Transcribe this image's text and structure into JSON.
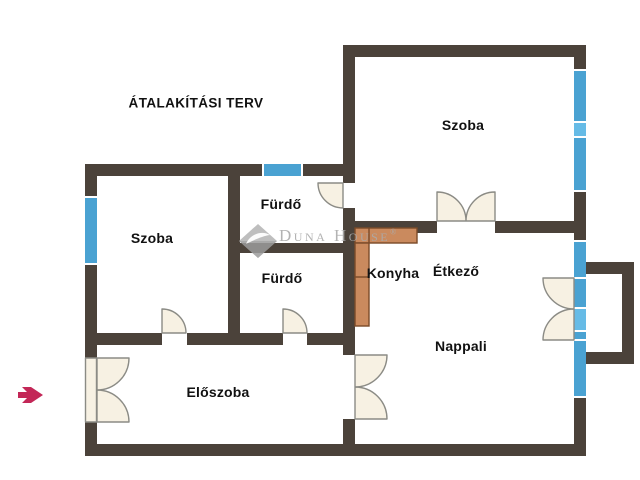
{
  "title": "ÁTALAKÍTÁSI TERV",
  "watermark": {
    "brand": "Duna House",
    "registered": "®"
  },
  "rooms": {
    "szoba_top": "Szoba",
    "szoba_left": "Szoba",
    "furdo_top": "Fürdő",
    "furdo_bottom": "Fürdő",
    "konyha": "Konyha",
    "etkezo": "Étkező",
    "nappali": "Nappali",
    "eloszoba": "Előszoba"
  },
  "icons": {
    "entrance_arrow": "entrance-arrow-icon",
    "brand_diamond": "brand-diamond-icon"
  },
  "colors": {
    "wall": "#4b423a",
    "window": "#4aa2d2",
    "window_light": "#66bbe6",
    "counter": "#ca8a5e",
    "counter_outline": "#7a4a28",
    "door_fill": "#f7f1e3",
    "door_outline": "#8b8b85",
    "arrow": "#c32757",
    "label": "#111111",
    "watermark": "#ababab",
    "background": "#ffffff"
  }
}
